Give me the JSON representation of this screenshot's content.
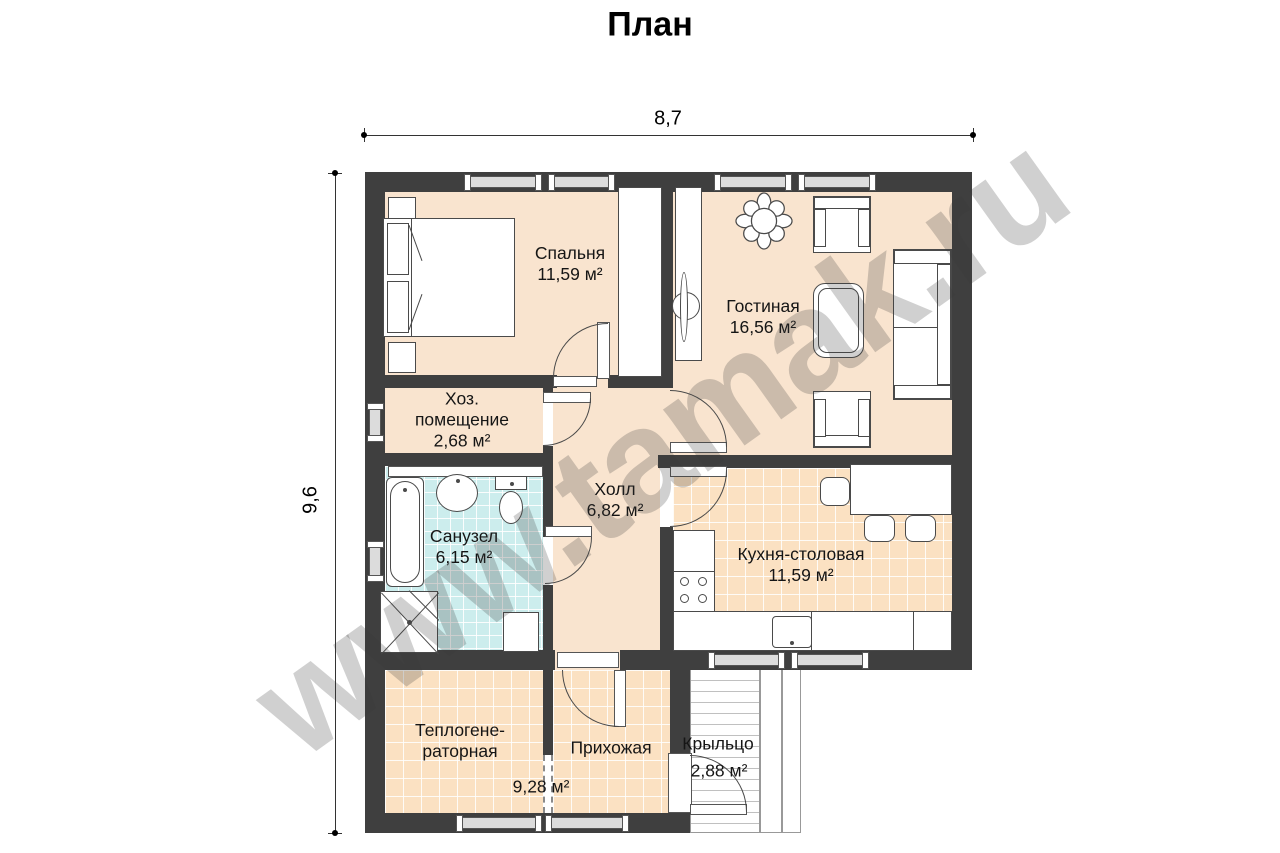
{
  "title": "План",
  "watermark": "www.tamak.ru",
  "dimensions": {
    "width": "8,7",
    "height": "9,6"
  },
  "rooms": {
    "bedroom": {
      "name": "Спальня",
      "area": "11,59 м²"
    },
    "living": {
      "name": "Гостиная",
      "area": "16,56 м²"
    },
    "utility": {
      "name_line1": "Хоз.",
      "name_line2": "помещение",
      "area": "2,68 м²"
    },
    "hall": {
      "name": "Холл",
      "area": "6,82 м²"
    },
    "bathroom": {
      "name": "Санузел",
      "area": "6,15 м²"
    },
    "kitchen": {
      "name": "Кухня-столовая",
      "area": "11,59 м²"
    },
    "boiler": {
      "name_line1": "Теплогене-",
      "name_line2": "раторная"
    },
    "entry": {
      "name": "Прихожая"
    },
    "boiler_entry_area": "9,28 м²",
    "porch": {
      "name": "Крыльцо",
      "area": "2,88 м²"
    }
  },
  "colors": {
    "wall": "#3f3f3f",
    "floor": "#f9e4cf",
    "tile_floor": "#fbe1c2",
    "bath_tile": "#cceded",
    "outline": "#4a4a4a",
    "watermark_gray": "#c8c8c8"
  }
}
